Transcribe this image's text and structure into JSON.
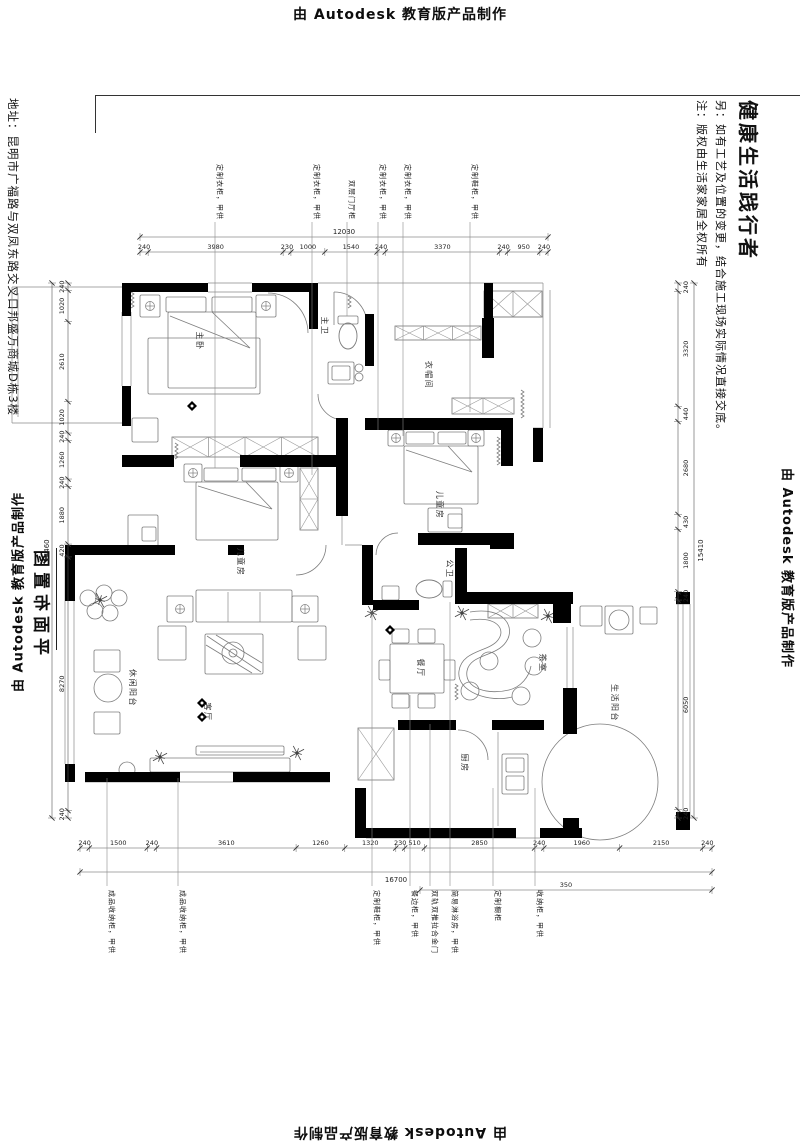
{
  "page": {
    "autodesk_top": "由 Autodesk 教育版产品制作",
    "autodesk_bottom": "由 Autodesk 教育版产品制作",
    "autodesk_left": "由 Autodesk 教育版产品制作",
    "autodesk_right": "由 Autodesk 教育版产品制作"
  },
  "title_block": {
    "slogan": "健康生活践行者",
    "note1": "另：如有工艺及位置的变更，结合施工现场实际情况直接交底。",
    "note2": "注：版权由生活家家居全权所有",
    "address": "地址：昆明市广福路与双凤东路交叉口邦盛万商城D栋3楼",
    "drawing_title": "平面布置图"
  },
  "plan": {
    "room_labels": [
      {
        "label": "主卧",
        "x": 197,
        "y": 341
      },
      {
        "label": "主卫",
        "x": 322,
        "y": 326
      },
      {
        "label": "衣帽间",
        "x": 426,
        "y": 375
      },
      {
        "label": "儿童房",
        "x": 437,
        "y": 505
      },
      {
        "label": "儿童房",
        "x": 238,
        "y": 562
      },
      {
        "label": "休闲阳台",
        "x": 130,
        "y": 688
      },
      {
        "label": "客厅",
        "x": 205,
        "y": 712
      },
      {
        "label": "餐厅",
        "x": 418,
        "y": 668
      },
      {
        "label": "茶室",
        "x": 540,
        "y": 663
      },
      {
        "label": "公卫",
        "x": 447,
        "y": 569
      },
      {
        "label": "厨房",
        "x": 462,
        "y": 763
      },
      {
        "label": "生活阳台",
        "x": 612,
        "y": 703
      }
    ],
    "callouts_top": [
      {
        "label": "定制衣柜，甲供",
        "x": 215,
        "end": 468
      },
      {
        "label": "定制衣柜，甲供",
        "x": 312,
        "end": 475
      },
      {
        "label": "双层门厅柜",
        "x": 347,
        "end": 316
      },
      {
        "label": "定制衣柜，甲供",
        "x": 378,
        "end": 430
      },
      {
        "label": "定制衣柜，甲供",
        "x": 403,
        "end": 436
      },
      {
        "label": "定制鞋柜，甲供",
        "x": 470,
        "end": 412
      }
    ],
    "callouts_bottom": [
      {
        "label": "成品收纳柜，甲供",
        "x": 107,
        "end": 778
      },
      {
        "label": "成品收纳柜，甲供",
        "x": 178,
        "end": 778
      },
      {
        "label": "定制鞋柜，甲供",
        "x": 372,
        "end": 612
      },
      {
        "label": "餐边柜，甲供",
        "x": 410,
        "end": 695
      },
      {
        "label": "双轨双推拉合金门",
        "x": 430,
        "end": 724
      },
      {
        "label": "简易淋浴房，甲供",
        "x": 450,
        "end": 602
      },
      {
        "label": "定制橱柜",
        "x": 493,
        "end": 788
      },
      {
        "label": "收纳柜，甲供",
        "x": 535,
        "end": 788
      }
    ],
    "dimensions": {
      "chains": [
        {
          "dir": "h",
          "from": 140,
          "to": 548,
          "line": 252,
          "labelOff": -3,
          "overLine": 237,
          "overLabelOff": -3,
          "segments": [
            240,
            3980,
            230,
            1000,
            1540,
            240,
            3370,
            240,
            950,
            240
          ],
          "overall": "12030"
        },
        {
          "dir": "h",
          "from": 80,
          "to": 712,
          "line": 848,
          "labelOff": -3,
          "overLine": 872,
          "overLabelOff": 10,
          "segments": [
            240,
            1500,
            240,
            3610,
            1260,
            1320,
            230,
            510,
            2850,
            240,
            1960,
            2150,
            240
          ],
          "overall": "16700"
        },
        {
          "dir": "h",
          "from": 420,
          "to": 712,
          "line": 890,
          "labelOff": -3,
          "segments": [
            350
          ]
        },
        {
          "dir": "v",
          "from": 283,
          "to": 818,
          "line": 68,
          "labelOff": -4,
          "overLine": 52,
          "overLabelOff": -3,
          "segments": [
            240,
            1020,
            2610,
            1020,
            240,
            1260,
            240,
            1880,
            420,
            8270,
            240
          ],
          "overall": "14460"
        },
        {
          "dir": "v",
          "from": 283,
          "to": 818,
          "line": 678,
          "labelOff": 10,
          "overLine": 694,
          "overLabelOff": 9,
          "segments": [
            240,
            3320,
            440,
            2680,
            430,
            1800,
            240,
            6050,
            240
          ],
          "overall": "15410"
        }
      ]
    },
    "geometry": {
      "walls": [
        [
          122,
          283,
          86,
          9
        ],
        [
          252,
          283,
          66,
          9
        ],
        [
          309,
          283,
          9,
          46
        ],
        [
          122,
          292,
          9,
          24
        ],
        [
          122,
          386,
          9,
          40
        ],
        [
          484,
          283,
          9,
          36
        ],
        [
          365,
          314,
          9,
          52
        ],
        [
          482,
          318,
          12,
          40
        ],
        [
          122,
          455,
          52,
          12
        ],
        [
          240,
          455,
          104,
          12
        ],
        [
          336,
          418,
          12,
          98
        ],
        [
          365,
          418,
          148,
          12
        ],
        [
          501,
          418,
          12,
          48
        ],
        [
          533,
          428,
          10,
          34
        ],
        [
          418,
          533,
          80,
          12
        ],
        [
          490,
          533,
          24,
          16
        ],
        [
          362,
          545,
          11,
          60
        ],
        [
          373,
          600,
          46,
          10
        ],
        [
          455,
          548,
          12,
          56
        ],
        [
          65,
          545,
          10,
          56
        ],
        [
          75,
          545,
          100,
          10
        ],
        [
          228,
          545,
          16,
          10
        ],
        [
          85,
          772,
          95,
          10
        ],
        [
          233,
          772,
          97,
          10
        ],
        [
          65,
          764,
          10,
          18
        ],
        [
          355,
          788,
          11,
          50
        ],
        [
          366,
          828,
          150,
          10
        ],
        [
          540,
          828,
          42,
          10
        ],
        [
          455,
          592,
          118,
          12
        ],
        [
          553,
          597,
          18,
          26
        ],
        [
          563,
          688,
          14,
          46
        ],
        [
          563,
          818,
          16,
          12
        ],
        [
          676,
          592,
          14,
          12
        ],
        [
          676,
          812,
          14,
          18
        ],
        [
          398,
          720,
          58,
          10
        ],
        [
          492,
          720,
          52,
          10
        ]
      ],
      "lines": [
        [
          12,
          287,
          122,
          287
        ],
        [
          12,
          287,
          12,
          423
        ],
        [
          12,
          423,
          122,
          423
        ],
        [
          18,
          293,
          18,
          417
        ],
        [
          122,
          312,
          122,
          386
        ],
        [
          131,
          312,
          131,
          386
        ],
        [
          208,
          283,
          252,
          283
        ],
        [
          208,
          292,
          252,
          292
        ],
        [
          318,
          283,
          543,
          283
        ],
        [
          543,
          283,
          543,
          428
        ],
        [
          550,
          290,
          550,
          428
        ],
        [
          533,
          428,
          543,
          428
        ],
        [
          486,
          283,
          486,
          317
        ],
        [
          486,
          317,
          543,
          317
        ],
        [
          65,
          556,
          65,
          764
        ],
        [
          74,
          556,
          74,
          764
        ],
        [
          683,
          604,
          683,
          818
        ],
        [
          690,
          604,
          690,
          818
        ],
        [
          676,
          604,
          690,
          604
        ],
        [
          676,
          818,
          690,
          818
        ],
        [
          366,
          838,
          540,
          838
        ],
        [
          85,
          782,
          330,
          782
        ],
        [
          345,
          545,
          362,
          545
        ],
        [
          342,
          516,
          342,
          545
        ],
        [
          498,
          732,
          498,
          826
        ],
        [
          567,
          627,
          567,
          688
        ],
        [
          573,
          627,
          573,
          688
        ],
        [
          228,
          592,
          228,
          622
        ],
        [
          260,
          592,
          260,
          622
        ],
        [
          200,
          752,
          284,
          752
        ]
      ],
      "hatch": [
        [
          484,
          291,
          58,
          26,
          2
        ],
        [
          395,
          326,
          86,
          14,
          3
        ],
        [
          452,
          398,
          62,
          16,
          2
        ],
        [
          172,
          437,
          146,
          20,
          4
        ],
        [
          300,
          468,
          18,
          62,
          2
        ],
        [
          488,
          604,
          50,
          14,
          2
        ],
        [
          358,
          728,
          36,
          52,
          1
        ]
      ],
      "rects": [
        [
          140,
          295,
          20,
          22
        ],
        [
          166,
          297,
          40,
          15
        ],
        [
          212,
          297,
          40,
          15
        ],
        [
          256,
          295,
          20,
          22
        ],
        [
          148,
          338,
          112,
          56
        ],
        [
          168,
          312,
          88,
          76
        ],
        [
          132,
          418,
          26,
          24
        ],
        [
          388,
          430,
          16,
          16
        ],
        [
          406,
          432,
          28,
          12
        ],
        [
          438,
          432,
          28,
          12
        ],
        [
          468,
          430,
          16,
          16
        ],
        [
          404,
          446,
          74,
          58
        ],
        [
          428,
          508,
          34,
          24
        ],
        [
          448,
          514,
          14,
          14
        ],
        [
          184,
          464,
          18,
          18
        ],
        [
          204,
          468,
          34,
          13
        ],
        [
          242,
          468,
          34,
          13
        ],
        [
          280,
          464,
          18,
          18
        ],
        [
          196,
          482,
          82,
          58
        ],
        [
          128,
          515,
          30,
          38
        ],
        [
          142,
          527,
          14,
          14
        ],
        [
          167,
          596,
          26,
          26
        ],
        [
          196,
          590,
          96,
          32
        ],
        [
          292,
          596,
          26,
          26
        ],
        [
          158,
          626,
          28,
          34
        ],
        [
          298,
          626,
          28,
          34
        ],
        [
          205,
          634,
          58,
          40
        ],
        [
          150,
          758,
          140,
          14
        ],
        [
          196,
          746,
          88,
          9
        ],
        [
          94,
          650,
          26,
          22
        ],
        [
          94,
          712,
          26,
          22
        ],
        [
          392,
          629,
          17,
          14
        ],
        [
          418,
          629,
          17,
          14
        ],
        [
          392,
          694,
          17,
          14
        ],
        [
          418,
          694,
          17,
          14
        ],
        [
          390,
          644,
          54,
          49
        ],
        [
          379,
          660,
          11,
          20
        ],
        [
          444,
          660,
          11,
          20
        ],
        [
          580,
          606,
          22,
          20
        ],
        [
          605,
          606,
          28,
          28
        ],
        [
          640,
          607,
          17,
          17
        ],
        [
          502,
          754,
          26,
          40
        ],
        [
          506,
          758,
          18,
          14
        ],
        [
          506,
          776,
          18,
          14
        ],
        [
          338,
          316,
          20,
          8
        ],
        [
          328,
          362,
          26,
          22
        ],
        [
          332,
          366,
          18,
          14
        ],
        [
          382,
          586,
          17,
          14
        ],
        [
          443,
          581,
          9,
          16
        ]
      ],
      "circles": [
        [
          88,
          598,
          8
        ],
        [
          104,
          593,
          8
        ],
        [
          119,
          598,
          8
        ],
        [
          95,
          611,
          8
        ],
        [
          110,
          613,
          8
        ],
        [
          108,
          688,
          14
        ],
        [
          532,
          638,
          9
        ],
        [
          489,
          661,
          9
        ],
        [
          534,
          666,
          9
        ],
        [
          470,
          691,
          9
        ],
        [
          521,
          696,
          9
        ],
        [
          233,
          653,
          11
        ],
        [
          233,
          653,
          4
        ],
        [
          600,
          782,
          58
        ],
        [
          619,
          620,
          10
        ],
        [
          127,
          770,
          8
        ],
        [
          359,
          368,
          4
        ],
        [
          359,
          377,
          4
        ]
      ],
      "ellipses": [
        [
          348,
          336,
          9,
          13
        ],
        [
          429,
          589,
          13,
          9
        ]
      ],
      "paths": [
        "M334,292 A33 33 0 0 1 367,325",
        "M334,292 L334,325",
        "M318,394 A26 26 0 0 0 344,420",
        "M326,545 A30 30 0 0 1 296,575",
        "M398,533 A22 22 0 0 0 376,555",
        "M458,730 A30 30 0 0 1 488,760",
        "M268,293 A40 40 0 0 1 308,333",
        "M470,612 C505,606 516,628 506,642 C496,657 470,654 467,671 C464,689 489,695 509,690 C521,687 529,677 531,666",
        "M470,620 C498,616 506,630 498,640 C489,652 462,650 459,671 C456,692 490,703 512,697",
        "M170,316 L250,348 L212,312",
        "M406,450 L472,472 L448,446",
        "M198,486 L272,509 L246,482",
        "M207,636 L261,672",
        "M216,635 L262,663",
        "M206,645 L252,673"
      ],
      "squiggles": [
        [
          131,
          292,
          16
        ],
        [
          175,
          443,
          14
        ],
        [
          521,
          390,
          26
        ],
        [
          497,
          437,
          26
        ],
        [
          455,
          684,
          16
        ],
        [
          348,
          296,
          10
        ]
      ],
      "crossmarks": [
        [
          150,
          306
        ],
        [
          266,
          306
        ],
        [
          396,
          438
        ],
        [
          476,
          438
        ],
        [
          193,
          473
        ],
        [
          289,
          473
        ],
        [
          180,
          609
        ],
        [
          305,
          609
        ]
      ],
      "plants": [
        [
          100,
          600
        ],
        [
          372,
          613
        ],
        [
          462,
          613
        ],
        [
          548,
          616
        ],
        [
          160,
          757
        ],
        [
          297,
          753
        ]
      ],
      "diamonds": [
        [
          192,
          406
        ],
        [
          202,
          703
        ],
        [
          202,
          717
        ],
        [
          390,
          630
        ]
      ]
    }
  }
}
